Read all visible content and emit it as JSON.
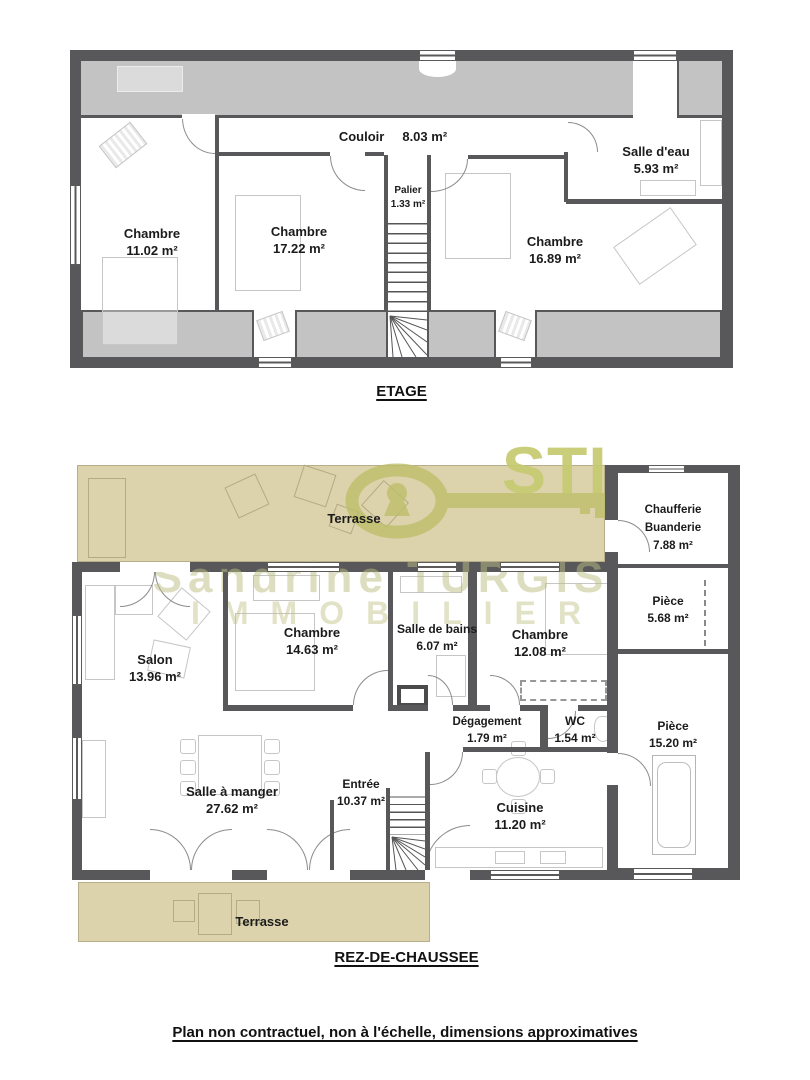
{
  "floors": {
    "etage": {
      "title": "ETAGE",
      "rooms": {
        "couloir": {
          "name": "Couloir",
          "area": "8.03 m²"
        },
        "salle_eau": {
          "name": "Salle d'eau",
          "area": "5.93 m²"
        },
        "palier": {
          "name": "Palier",
          "area": "1.33 m²"
        },
        "chambre1": {
          "name": "Chambre",
          "area": "11.02 m²"
        },
        "chambre2": {
          "name": "Chambre",
          "area": "17.22 m²"
        },
        "chambre3": {
          "name": "Chambre",
          "area": "16.89 m²"
        }
      }
    },
    "rdc": {
      "title": "REZ-DE-CHAUSSEE",
      "rooms": {
        "terrasse_nord": {
          "name": "Terrasse"
        },
        "chaufferie": {
          "name": "Chaufferie Buanderie",
          "area": "7.88 m²"
        },
        "piece_a": {
          "name": "Pièce",
          "area": "5.68 m²"
        },
        "piece_b": {
          "name": "Pièce",
          "area": "15.20 m²"
        },
        "salon": {
          "name": "Salon",
          "area": "13.96 m²"
        },
        "chambre4": {
          "name": "Chambre",
          "area": "14.63 m²"
        },
        "salle_bains": {
          "name": "Salle de bains",
          "area": "6.07 m²"
        },
        "chambre5": {
          "name": "Chambre",
          "area": "12.08 m²"
        },
        "degagement": {
          "name": "Dégagement",
          "area": "1.79 m²"
        },
        "wc": {
          "name": "WC",
          "area": "1.54 m²"
        },
        "salle_manger": {
          "name": "Salle à manger",
          "area": "27.62 m²"
        },
        "entree": {
          "name": "Entrée",
          "area": "10.37 m²"
        },
        "cuisine": {
          "name": "Cuisine",
          "area": "11.20 m²"
        },
        "terrasse_sud": {
          "name": "Terrasse"
        }
      }
    }
  },
  "watermark": {
    "logo_text": "STI",
    "agency_line1": "Sandrine TURGIS",
    "agency_line2": "IMMOBILIER"
  },
  "footer_note": "Plan non contractuel, non à l'échelle, dimensions approximatives",
  "colors": {
    "wall": "#58585a",
    "attic": "#c3c3c3",
    "terrace": "#dcd2ab",
    "watermark_olive": "#c6ca70"
  }
}
